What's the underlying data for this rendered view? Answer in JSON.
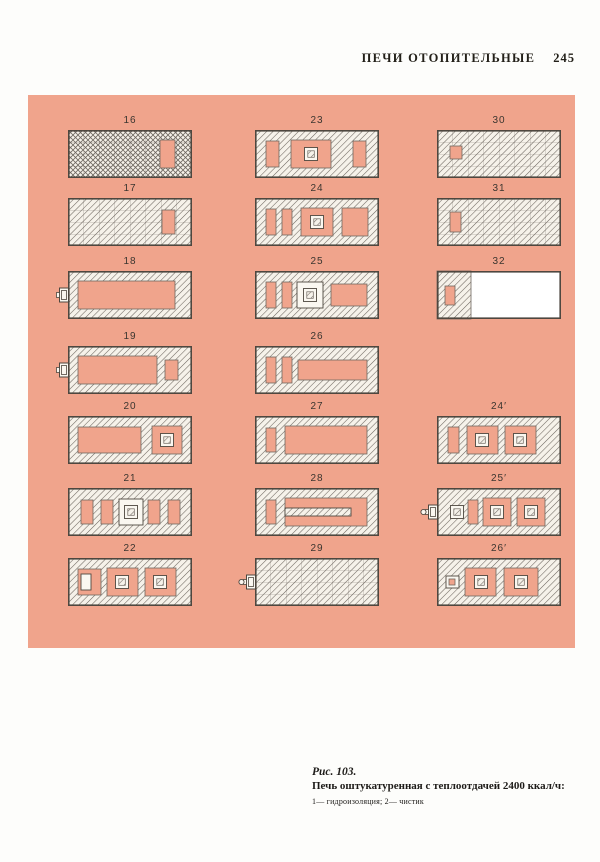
{
  "header": {
    "title": "ПЕЧИ ОТОПИТЕЛЬНЫЕ",
    "page_number": "245"
  },
  "figure": {
    "caption_fig": "Рис. 103.",
    "caption_title": "Печь оштукатуренная с теплоотдачей 2400 ккал/ч:",
    "caption_legend": "1— гидроизоляция; 2— чистик",
    "colors": {
      "panel": "#f0a48c",
      "brick": "#f6f2ea",
      "hatch": "#6e6760",
      "outline": "#4e473f",
      "white": "#faf7f0"
    },
    "diagrams": [
      {
        "label": "16",
        "col": 0,
        "row": 0,
        "base": "cross",
        "parts": [
          {
            "t": "void",
            "x": 92,
            "y": 10,
            "w": 15,
            "h": 28
          }
        ]
      },
      {
        "label": "17",
        "col": 0,
        "row": 1,
        "base": "diag",
        "parts": [
          {
            "t": "void",
            "x": 94,
            "y": 12,
            "w": 13,
            "h": 24
          }
        ]
      },
      {
        "label": "18",
        "col": 0,
        "row": 2,
        "base": "hollow",
        "parts": [
          {
            "t": "door"
          },
          {
            "t": "void",
            "x": 10,
            "y": 10,
            "w": 97,
            "h": 28
          }
        ]
      },
      {
        "label": "19",
        "col": 0,
        "row": 3,
        "base": "hollow",
        "parts": [
          {
            "t": "door"
          },
          {
            "t": "void",
            "x": 10,
            "y": 10,
            "w": 79,
            "h": 28
          },
          {
            "t": "void",
            "x": 97,
            "y": 14,
            "w": 13,
            "h": 20
          }
        ]
      },
      {
        "label": "20",
        "col": 0,
        "row": 4,
        "base": "hollow",
        "parts": [
          {
            "t": "void",
            "x": 10,
            "y": 11,
            "w": 63,
            "h": 26
          },
          {
            "t": "void",
            "x": 84,
            "y": 10,
            "w": 30,
            "h": 28
          },
          {
            "t": "box",
            "cx": 99,
            "cy": 24
          }
        ]
      },
      {
        "label": "21",
        "col": 0,
        "row": 5,
        "base": "hollow",
        "parts": [
          {
            "t": "void",
            "x": 13,
            "y": 12,
            "w": 12,
            "h": 24
          },
          {
            "t": "void",
            "x": 33,
            "y": 12,
            "w": 12,
            "h": 24
          },
          {
            "t": "wbox",
            "x": 51,
            "y": 11,
            "w": 24,
            "h": 26
          },
          {
            "t": "box",
            "cx": 63,
            "cy": 24
          },
          {
            "t": "void",
            "x": 80,
            "y": 12,
            "w": 12,
            "h": 24
          },
          {
            "t": "void",
            "x": 100,
            "y": 12,
            "w": 12,
            "h": 24
          }
        ]
      },
      {
        "label": "22",
        "col": 0,
        "row": 6,
        "base": "hollow",
        "parts": [
          {
            "t": "void",
            "x": 10,
            "y": 11,
            "w": 23,
            "h": 26
          },
          {
            "t": "wbox",
            "x": 13,
            "y": 16,
            "w": 10,
            "h": 16
          },
          {
            "t": "void",
            "x": 39,
            "y": 10,
            "w": 31,
            "h": 28
          },
          {
            "t": "box",
            "cx": 54,
            "cy": 24
          },
          {
            "t": "void",
            "x": 77,
            "y": 10,
            "w": 31,
            "h": 28
          },
          {
            "t": "box",
            "cx": 92,
            "cy": 24
          }
        ]
      },
      {
        "label": "23",
        "col": 1,
        "row": 0,
        "base": "hollow",
        "parts": [
          {
            "t": "void",
            "x": 11,
            "y": 11,
            "w": 13,
            "h": 26
          },
          {
            "t": "void",
            "x": 36,
            "y": 10,
            "w": 40,
            "h": 28
          },
          {
            "t": "box",
            "cx": 56,
            "cy": 24
          },
          {
            "t": "void",
            "x": 98,
            "y": 11,
            "w": 13,
            "h": 26
          }
        ]
      },
      {
        "label": "24",
        "col": 1,
        "row": 1,
        "base": "hollow",
        "parts": [
          {
            "t": "void",
            "x": 11,
            "y": 11,
            "w": 10,
            "h": 26
          },
          {
            "t": "void",
            "x": 27,
            "y": 11,
            "w": 10,
            "h": 26
          },
          {
            "t": "void",
            "x": 46,
            "y": 10,
            "w": 32,
            "h": 28
          },
          {
            "t": "box",
            "cx": 62,
            "cy": 24
          },
          {
            "t": "void",
            "x": 87,
            "y": 10,
            "w": 26,
            "h": 28
          }
        ]
      },
      {
        "label": "25",
        "col": 1,
        "row": 2,
        "base": "hollow",
        "parts": [
          {
            "t": "void",
            "x": 11,
            "y": 11,
            "w": 10,
            "h": 26
          },
          {
            "t": "void",
            "x": 27,
            "y": 11,
            "w": 10,
            "h": 26
          },
          {
            "t": "wbox",
            "x": 42,
            "y": 11,
            "w": 26,
            "h": 26
          },
          {
            "t": "box",
            "cx": 55,
            "cy": 24
          },
          {
            "t": "void",
            "x": 76,
            "y": 13,
            "w": 36,
            "h": 22
          }
        ]
      },
      {
        "label": "26",
        "col": 1,
        "row": 3,
        "base": "hollow",
        "parts": [
          {
            "t": "void",
            "x": 11,
            "y": 11,
            "w": 10,
            "h": 26
          },
          {
            "t": "void",
            "x": 27,
            "y": 11,
            "w": 10,
            "h": 26
          },
          {
            "t": "void",
            "x": 43,
            "y": 14,
            "w": 69,
            "h": 20
          }
        ]
      },
      {
        "label": "27",
        "col": 1,
        "row": 4,
        "base": "hollow",
        "parts": [
          {
            "t": "void",
            "x": 11,
            "y": 12,
            "w": 10,
            "h": 24
          },
          {
            "t": "void",
            "x": 30,
            "y": 10,
            "w": 82,
            "h": 28
          }
        ]
      },
      {
        "label": "28",
        "col": 1,
        "row": 5,
        "base": "hollow",
        "parts": [
          {
            "t": "void",
            "x": 11,
            "y": 12,
            "w": 10,
            "h": 24
          },
          {
            "t": "void",
            "x": 30,
            "y": 10,
            "w": 82,
            "h": 28
          },
          {
            "t": "bar",
            "x": 30,
            "y": 20,
            "w": 66,
            "h": 8
          }
        ]
      },
      {
        "label": "29",
        "col": 1,
        "row": 6,
        "base": "diag",
        "parts": [
          {
            "t": "door2"
          }
        ]
      },
      {
        "label": "30",
        "col": 2,
        "row": 0,
        "base": "diag",
        "parts": [
          {
            "t": "void",
            "x": 13,
            "y": 16,
            "w": 12,
            "h": 13
          }
        ]
      },
      {
        "label": "31",
        "col": 2,
        "row": 1,
        "base": "diag",
        "parts": [
          {
            "t": "void",
            "x": 13,
            "y": 14,
            "w": 11,
            "h": 20
          }
        ]
      },
      {
        "label": "32",
        "col": 2,
        "row": 2,
        "base": "slab",
        "parts": [
          {
            "t": "void",
            "x": 8,
            "y": 15,
            "w": 10,
            "h": 19
          }
        ]
      },
      {
        "label": "24′",
        "col": 2,
        "row": 4,
        "base": "hollow",
        "parts": [
          {
            "t": "void",
            "x": 11,
            "y": 11,
            "w": 11,
            "h": 26
          },
          {
            "t": "void",
            "x": 30,
            "y": 10,
            "w": 31,
            "h": 28
          },
          {
            "t": "box",
            "cx": 45,
            "cy": 24
          },
          {
            "t": "void",
            "x": 68,
            "y": 10,
            "w": 31,
            "h": 28
          },
          {
            "t": "box",
            "cx": 83,
            "cy": 24
          }
        ]
      },
      {
        "label": "25′",
        "col": 2,
        "row": 5,
        "base": "hollow",
        "parts": [
          {
            "t": "door2"
          },
          {
            "t": "box",
            "cx": 20,
            "cy": 24
          },
          {
            "t": "void",
            "x": 31,
            "y": 12,
            "w": 10,
            "h": 24
          },
          {
            "t": "void",
            "x": 46,
            "y": 10,
            "w": 28,
            "h": 28
          },
          {
            "t": "box",
            "cx": 60,
            "cy": 24
          },
          {
            "t": "void",
            "x": 80,
            "y": 10,
            "w": 28,
            "h": 28
          },
          {
            "t": "box",
            "cx": 94,
            "cy": 24
          }
        ]
      },
      {
        "label": "26′",
        "col": 2,
        "row": 6,
        "base": "hollow",
        "parts": [
          {
            "t": "wbox",
            "x": 9,
            "y": 18,
            "w": 13,
            "h": 12
          },
          {
            "t": "void",
            "x": 12,
            "y": 21,
            "w": 6,
            "h": 6
          },
          {
            "t": "void",
            "x": 28,
            "y": 10,
            "w": 31,
            "h": 28
          },
          {
            "t": "box",
            "cx": 44,
            "cy": 24
          },
          {
            "t": "void",
            "x": 67,
            "y": 10,
            "w": 34,
            "h": 28
          },
          {
            "t": "box",
            "cx": 84,
            "cy": 24
          }
        ]
      }
    ]
  }
}
